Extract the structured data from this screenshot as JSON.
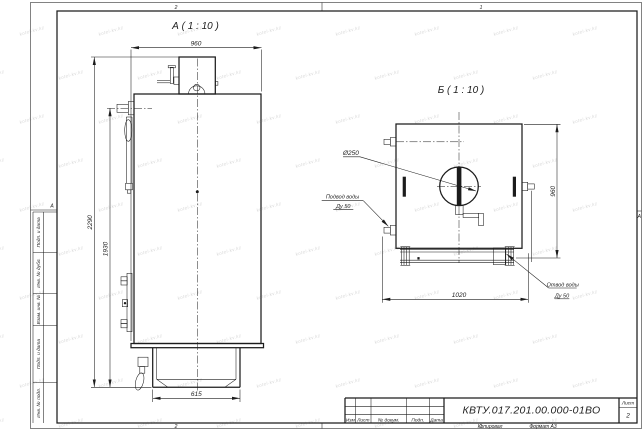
{
  "sheet": {
    "watermark": "kotel-kv.kz",
    "zone_top_left": "2",
    "zone_top_right": "1",
    "zone_bottom_left": "2",
    "zone_bottom_right": "1",
    "zone_row_letter": "А",
    "stamp_strip": {
      "s1": "Подп. и дата",
      "s2": "Инв. № дубл.",
      "s3": "Взам. инв. №",
      "s4": "Подп. и дата",
      "s5": "Инв. № подл."
    },
    "footer": {
      "copied": "Копировал",
      "format": "Формат А3"
    }
  },
  "title_block": {
    "doc_number": "КВТУ.017.201.00.000-01ВО",
    "sheet_label": "Лист",
    "sheet_number": "2",
    "col_izm": "Изм",
    "col_list": "Лист",
    "col_doc": "№ докум.",
    "col_podp": "Подп.",
    "col_data": "Дата"
  },
  "view_a": {
    "title": "А ( 1 : 10 )",
    "dim_width_top": "960",
    "dim_height_total": "2290",
    "dim_height_body": "1930",
    "dim_base_width": "615"
  },
  "view_b": {
    "title": "Б ( 1 : 10 )",
    "dim_height": "960",
    "dim_width_bottom": "1020",
    "dim_door": "Ø250",
    "label_inlet_1": "Подвод воды",
    "label_inlet_2": "Ду 50",
    "label_outlet_1": "Отвод воды",
    "label_outlet_2": "Ду 50"
  }
}
